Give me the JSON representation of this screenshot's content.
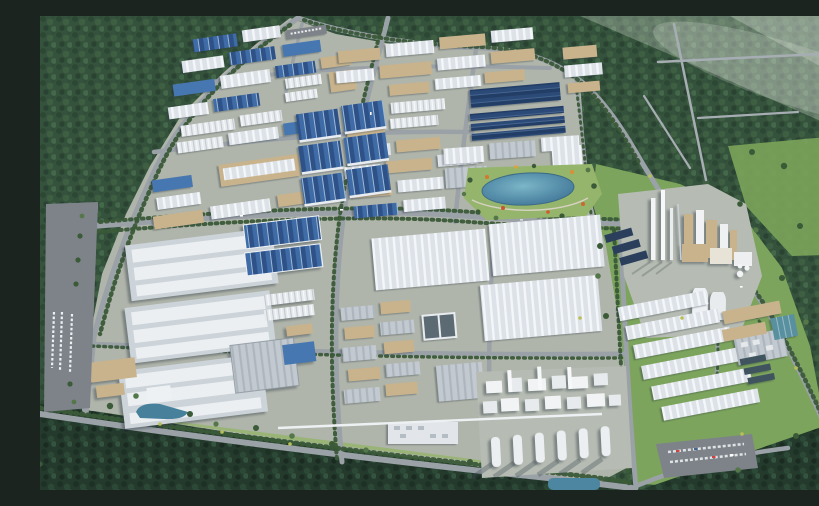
{
  "scene": {
    "title": "Aerial 3D rendering of a large industrial park surrounded by forest",
    "type": "3d-architectural-visualization",
    "view": "high-angle bird's-eye view",
    "regions": {
      "northwest_forest": "dense dark-green forest with curved perimeter road",
      "northeast_forest": "hazy forest crossed by thin rural roads",
      "upper_left_factories": "grid of factories with blue and gray roofs and white silo rows",
      "top_center_factories": "tan-walled plants with gray and dark solar-panel roofs",
      "blue_warehouse_block": "six large steel-blue panel-roof warehouses",
      "lake_park": "landscaped park with teal lake, flower beds and paths",
      "central_warehouses": "long white ridged warehouse halls and small workshop grid",
      "left_mega_warehouses": "three huge white logistics warehouses with raised roof strips",
      "chemical_plant": "white process towers, tall stacks and cooling towers on a gray pad",
      "plant_warehouses": "rows of long white sheds south of the plant",
      "tank_farm": "dense white process units with a front row of cylindrical silos",
      "southeast_buildings": "gray flat buildings with rooftop units and offices",
      "water_treatment": "rectangular dark and teal treatment pools",
      "parking_lots": "asphalt lots with rows of parked cars",
      "south_forest": "dark forest belt along the lower edge with a diagonal road",
      "pipe_rack": "white elevated pipeline crossing the southern blocks"
    }
  },
  "palette": {
    "forest_base": "#35523c",
    "forest_dark": "#243a2c",
    "grass": "#7ca45c",
    "lawn": "#95b46c",
    "meadow": "#7ba45a",
    "ground": "#b0b5ab",
    "pad": "#b6bcb3",
    "road": "#9aa1a7",
    "road_thin": "#a6adb3",
    "asphalt": "#7e838a",
    "tree_row": "#3a5a38",
    "roof_blue": "#4677b0",
    "roof_blue_dark": "#2e4f80",
    "panel_navy": "#2f4f7e",
    "roof_white": "#e9edf1",
    "roof_gray": "#c6ccd3",
    "roof_slate": "#99a3ac",
    "wall_tan": "#c8b38c",
    "lake": "#4f8da9",
    "lake_light": "#7cb6c8",
    "pond": "#47809b",
    "pool_dark": "#3f545e",
    "pool_teal": "#59909f",
    "haze": "#e8efe6",
    "flower_orange": "#d4772f",
    "flower_red": "#c9552e",
    "accent_yellow": "#b9bf58"
  }
}
